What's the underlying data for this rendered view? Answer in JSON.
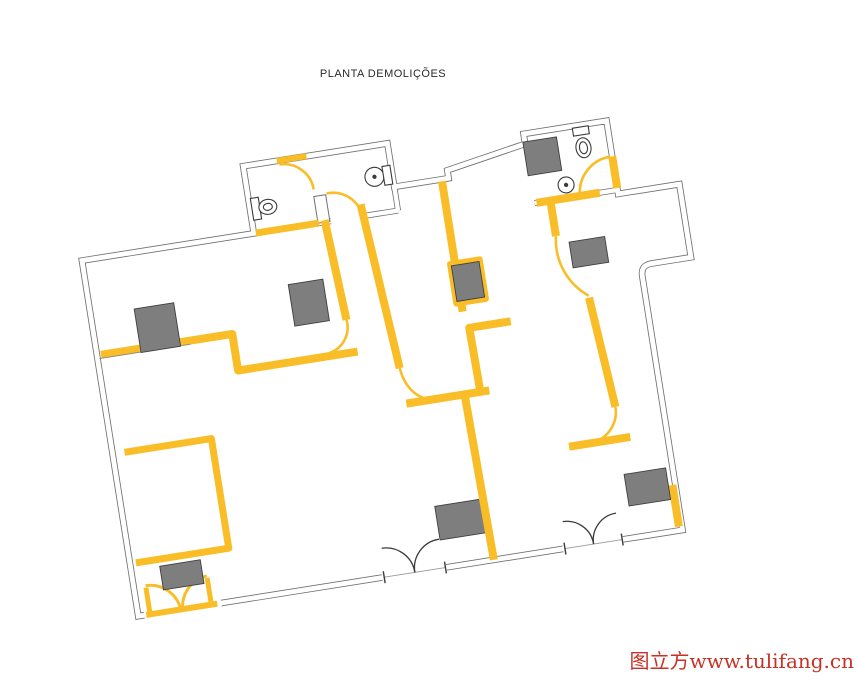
{
  "title": {
    "text": "PLANTA DEMOLIÇÕES",
    "color": "#2A2A2A"
  },
  "watermark": {
    "text": "图立方www.tulifang.cn",
    "color": "#C63226"
  },
  "colors": {
    "background": "#FFFFFF",
    "demolition": "#F9BE27",
    "wall_line": "#707070",
    "block_fill": "#7E7E7E",
    "block_border": "#3F3F3F",
    "door_arc": "#3A3A3A",
    "threshold": "#9A9A9A"
  },
  "fixtures": {
    "toilets": 3,
    "washbasins": 1
  }
}
